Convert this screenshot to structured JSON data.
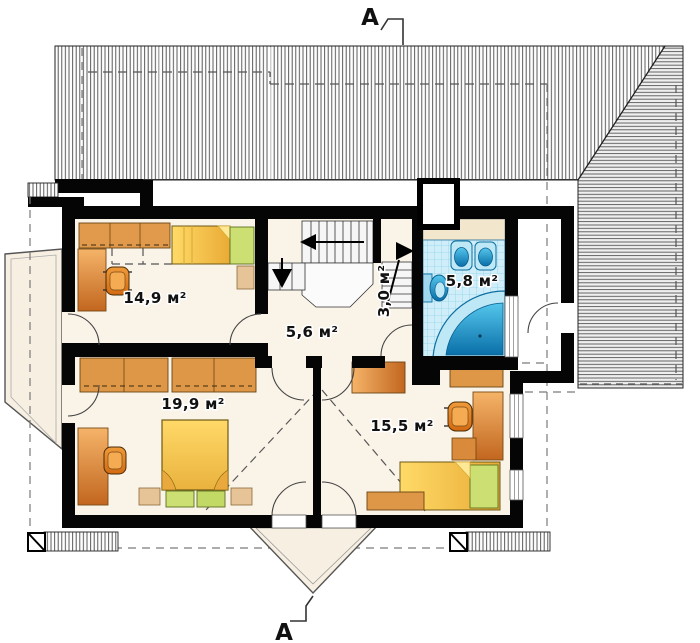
{
  "drawing": {
    "type": "attic floor plan",
    "section_markers": {
      "top": "A",
      "bottom": "A"
    },
    "rooms": {
      "bedroom1": {
        "label": "14,9 м²"
      },
      "hall": {
        "label": "5,6 м²"
      },
      "stairs": {
        "label": "3,0 м²"
      },
      "bathroom": {
        "label": "5,8 м²"
      },
      "bedroom2": {
        "label": "19,9 м²"
      },
      "bedroom3": {
        "label": "15,5 м²"
      }
    },
    "colors": {
      "wall": "#050505",
      "floor": "#faf3e8",
      "terrace": "#f6efe2",
      "furniture_orange": "#e09a4b",
      "furniture_orange_dark": "#c2661f",
      "bed_yellow": "#f2c54b",
      "accent_green": "#ccdf72",
      "nightstand_tan": "#e7c497",
      "bath_tile": "#cfeef9",
      "bath_fixture_blue": "#1f9cd4",
      "hatch_line": "#4a4a4a",
      "dash_line": "#777777"
    }
  }
}
